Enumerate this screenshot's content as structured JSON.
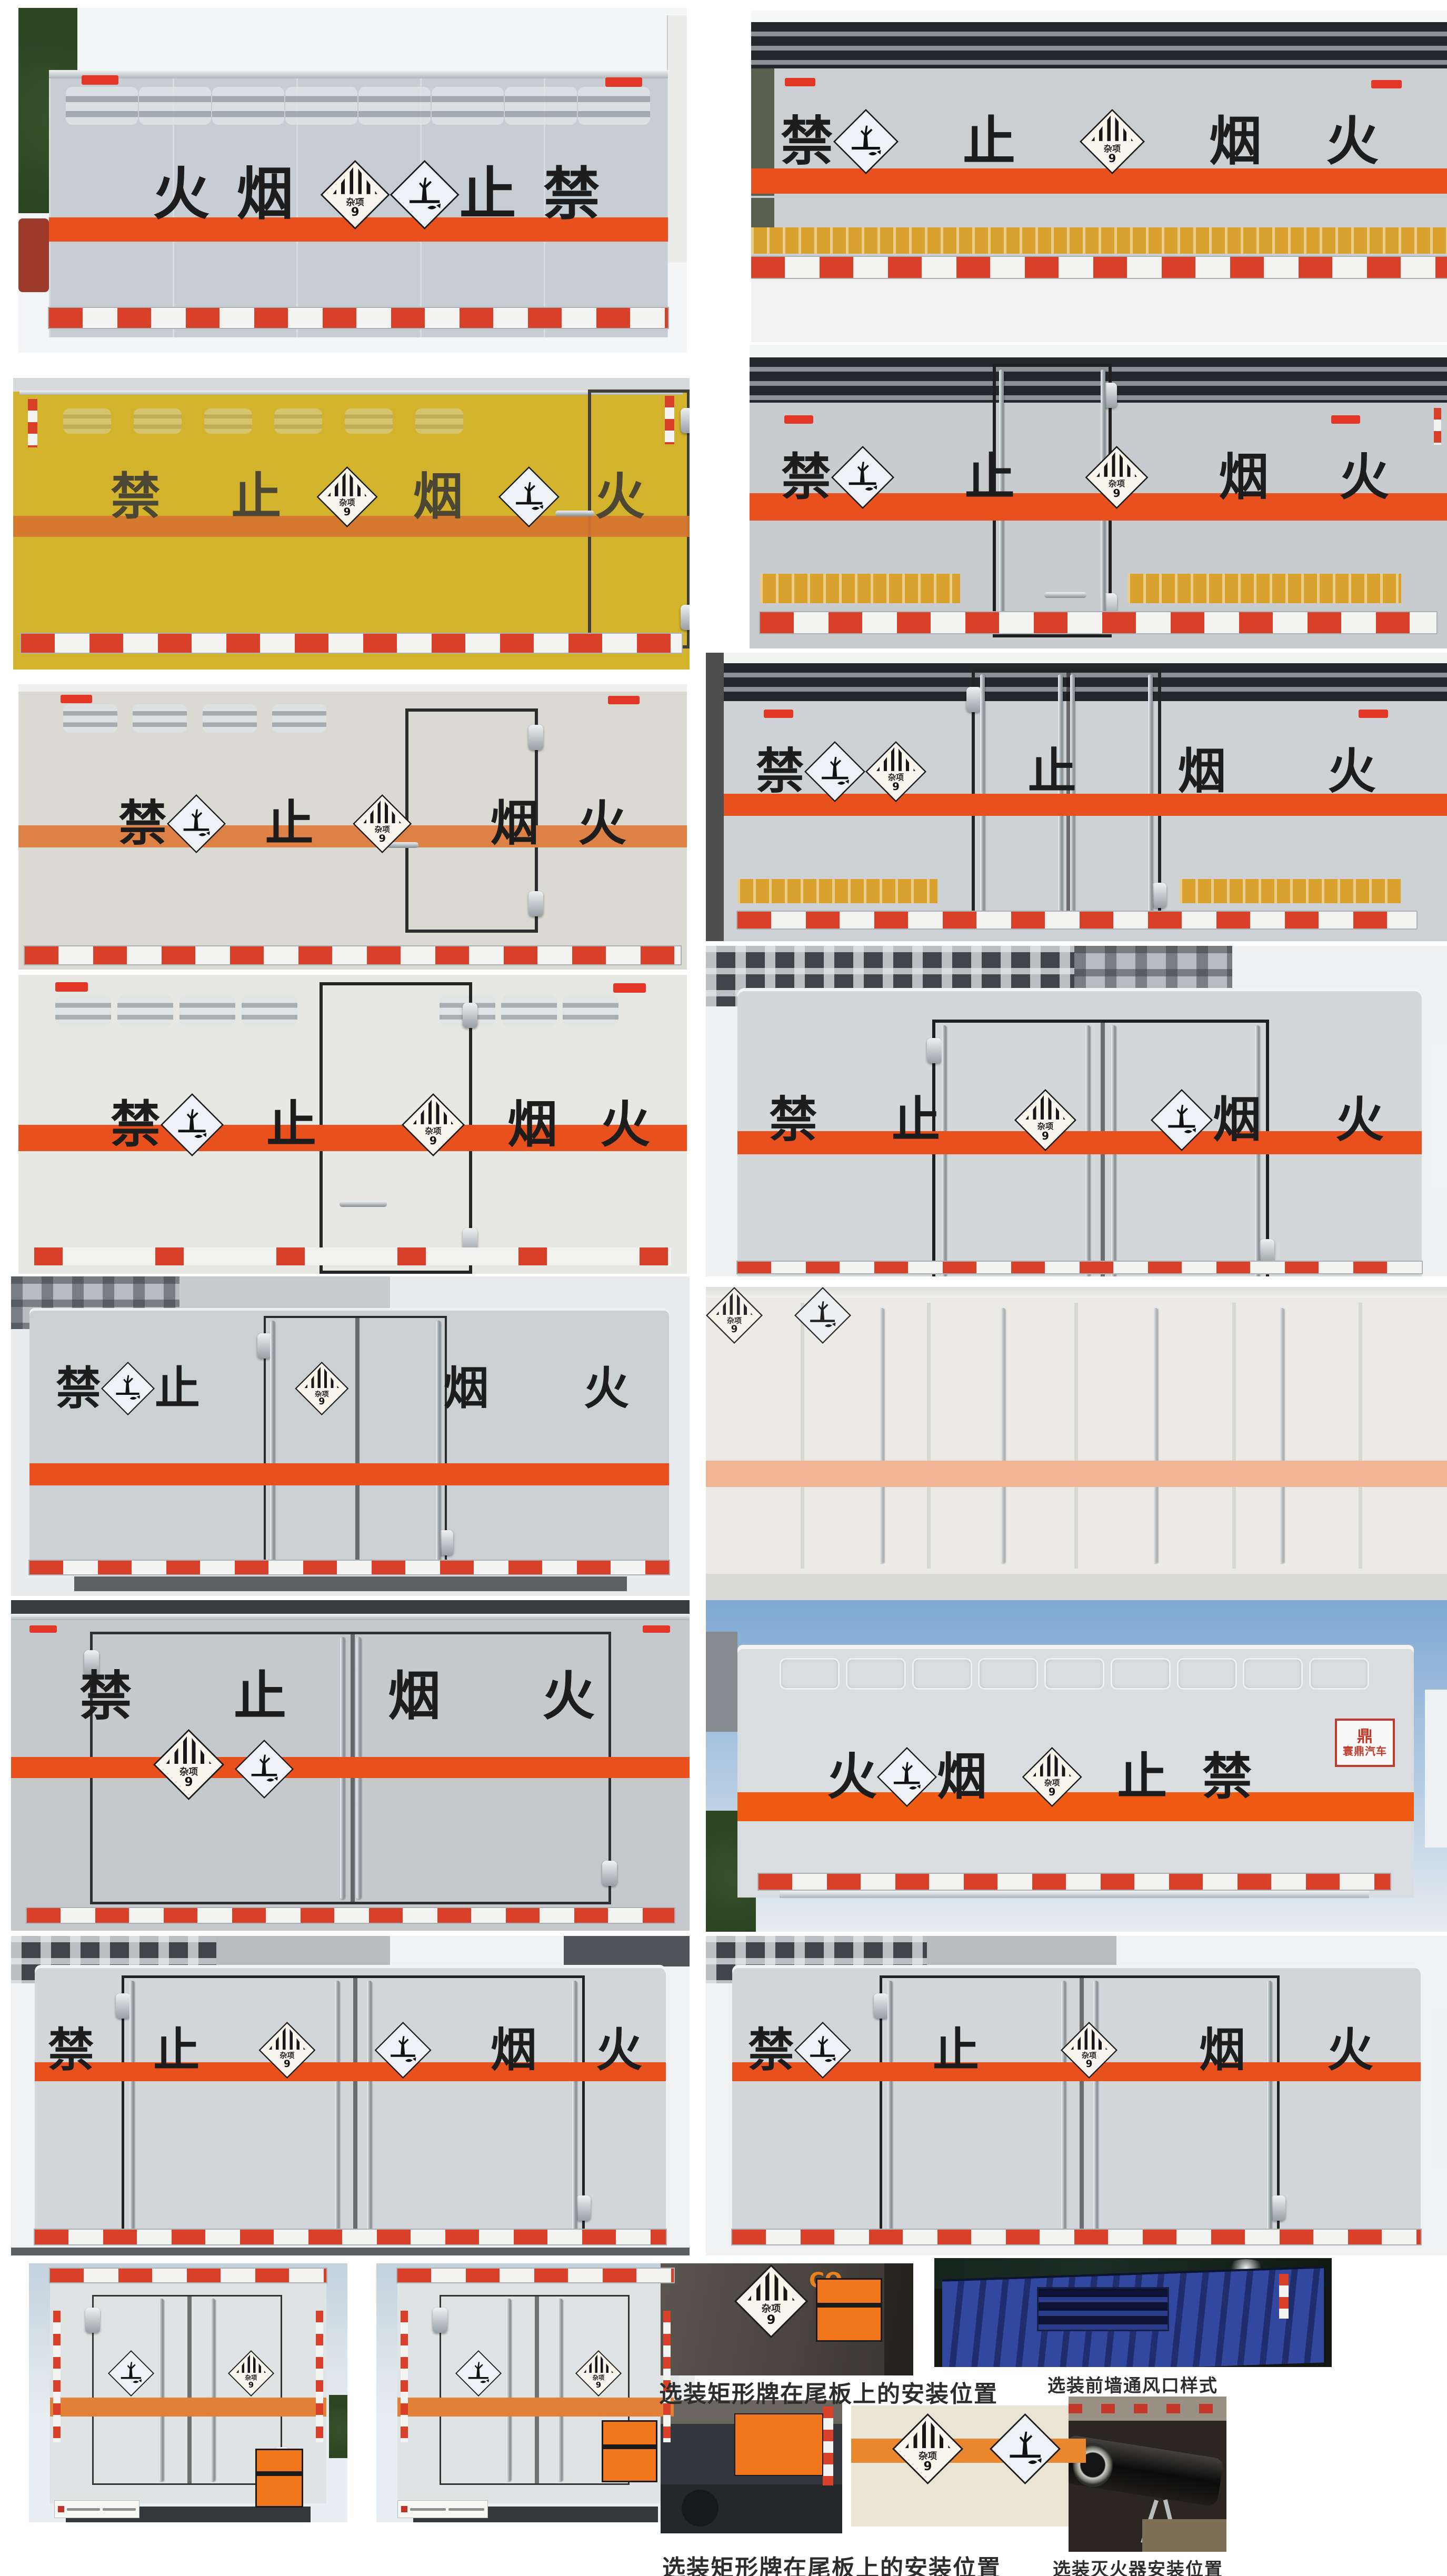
{
  "warning": {
    "phrase": "禁止烟火"
  },
  "brand": {
    "name": "寰鼎汽车"
  },
  "placards": {
    "misc_label": "杂项",
    "misc_class": "9",
    "misc_icon": "class9-misc-placard-icon",
    "env_icon": "environment-hazard-placard-icon"
  },
  "captions": {
    "c1": "选装矩形牌在尾板上的安装位置",
    "c2": "选装矩形牌在尾板上的安装位置",
    "c3": "选装前墙通风口样式",
    "c4": "选装灭火器安装位置"
  },
  "colors": {
    "stripe": "#e8501e",
    "stripe_soft": "#dd8146",
    "stripe_pale": "#f0b394",
    "gold": "#d9a22e",
    "panel": "#c6ced4",
    "yellow_truck": "#d2b32b",
    "sky_blue": "#7fa9d4",
    "logo_red": "#c0392b",
    "plate_orange": "#f2761c",
    "refl_red": "#d8402a",
    "vent_blue": "#32479f"
  },
  "photos": {
    "p1l": {
      "seq": [
        "火",
        "g",
        "烟",
        "g",
        "d9",
        "denv",
        "止",
        "g",
        "禁"
      ]
    },
    "p1r": {
      "seq": [
        "禁",
        "denv",
        "g",
        "止",
        "g",
        "d9",
        "g",
        "烟",
        "g",
        "火"
      ]
    },
    "p2l": {
      "seq": [
        "禁",
        "g",
        "g",
        "止",
        "g",
        "d9",
        "g",
        "烟",
        "g",
        "denv",
        "g",
        "火"
      ]
    },
    "p2r": {
      "seq": [
        "禁",
        "denv",
        "g",
        "止",
        "g",
        "d9",
        "g",
        "烟",
        "g",
        "火"
      ]
    },
    "p3l": {
      "seq": [
        "禁",
        "denv",
        "g",
        "止",
        "g",
        "d9",
        "g",
        "g",
        "烟",
        "g",
        "火"
      ]
    },
    "p3r": {
      "seq": [
        "禁",
        "denv",
        "d9",
        "g",
        "止",
        "g",
        "烟",
        "g",
        "火"
      ]
    },
    "p4l": {
      "seq": [
        "禁",
        "denv",
        "g",
        "止",
        "g",
        "g",
        "d9",
        "g",
        "烟",
        "g",
        "火"
      ]
    },
    "p4r": {
      "seq": [
        "禁",
        "g",
        "止",
        "g",
        "d9",
        "g",
        "denv",
        "烟",
        "g",
        "火"
      ]
    },
    "p5l": {
      "seq": [
        "禁",
        "denv",
        "止",
        "g",
        "d9",
        "g",
        "烟",
        "g",
        "火"
      ]
    },
    "p5r": {
      "dm": [
        "d9",
        "denv"
      ]
    },
    "p6l": {
      "seq": [
        "禁",
        "g",
        "止",
        "g",
        "烟",
        "g",
        "火"
      ],
      "dm1": [
        "d9"
      ],
      "dm2": [
        "denv"
      ]
    },
    "p6r": {
      "seq": [
        "火",
        "denv",
        "烟",
        "g",
        "d9",
        "g",
        "止",
        "g",
        "禁"
      ]
    },
    "p7l": {
      "seq": [
        "禁",
        "g",
        "止",
        "g",
        "d9",
        "g",
        "denv",
        "g",
        "烟",
        "g",
        "火"
      ]
    },
    "p7r": {
      "seq": [
        "禁",
        "denv",
        "g",
        "止",
        "g",
        "d9",
        "g",
        "烟",
        "g",
        "火"
      ]
    },
    "p8a": {
      "dm1": [
        "denv"
      ],
      "dm2": [
        "d9"
      ]
    },
    "p8b": {
      "dm1": [
        "denv"
      ],
      "dm2": [
        "d9"
      ]
    },
    "p8c": {
      "dm1": [
        "d9"
      ],
      "marking": "CO."
    },
    "p8e": {
      "dm1": [
        "d9"
      ],
      "dm2": [
        "denv"
      ]
    }
  }
}
